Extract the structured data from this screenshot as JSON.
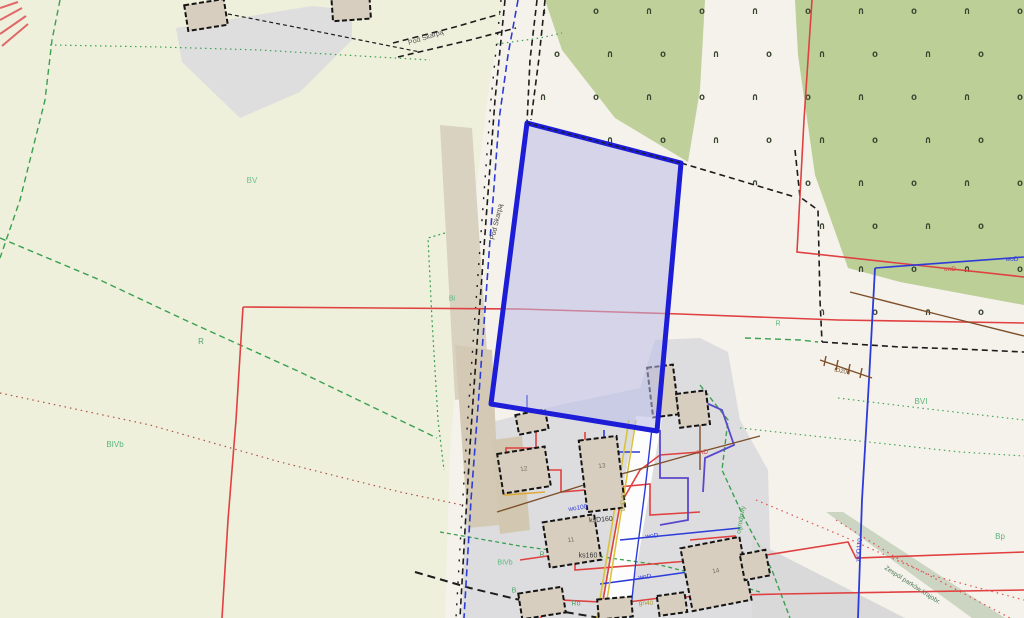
{
  "streets": {
    "pod_skarpa_top": "Pod Skarpą",
    "pod_skarpa_side": "Pod Skarpą",
    "diag_road": "Zespól parków krajobr.",
    "cluster_road": "ogrodowy"
  },
  "area_labels": {
    "bv": "BV",
    "r_left": "R",
    "bivb_left": "BIVb",
    "bi": "Bi",
    "bvi": "BVI",
    "bp": "Bp",
    "r_right": "R",
    "r_cluster": "R",
    "bivb_cluster": "BIVb",
    "b_cluster": "B",
    "ro": "Ro"
  },
  "utilities": {
    "ond": "onD",
    "wod110": "woD110",
    "wod_right": "woD",
    "td200": "tD200",
    "wo100": "wo100",
    "ksd160": "ksD160",
    "ks160": "ks160",
    "wod": "woD",
    "wnd": "wnD",
    "end": "enD",
    "gn40": "gn40",
    "gnd40": "gnD40"
  },
  "buildings": {
    "b11": "11",
    "b12": "12",
    "b13": "13",
    "b14": "14"
  },
  "pattern": {
    "glyph_a": "∩",
    "glyph_b": "o"
  },
  "colors": {
    "field": "#eef0dc",
    "beige": "#f5f2eb",
    "orchard_green": "#c0d09a",
    "parcel_stroke": "#1d1dd8",
    "parcel_fill": "#b9bce8",
    "power_red": "#e04040",
    "water_blue": "#2d3cd8",
    "purple": "#5a48cc",
    "gas_yellow": "#d9c33d",
    "telecom_brown": "#7d4f2a",
    "boundary_green": "#3aa050",
    "gray": "#dcdcde",
    "tan": "#d9d2c0"
  }
}
